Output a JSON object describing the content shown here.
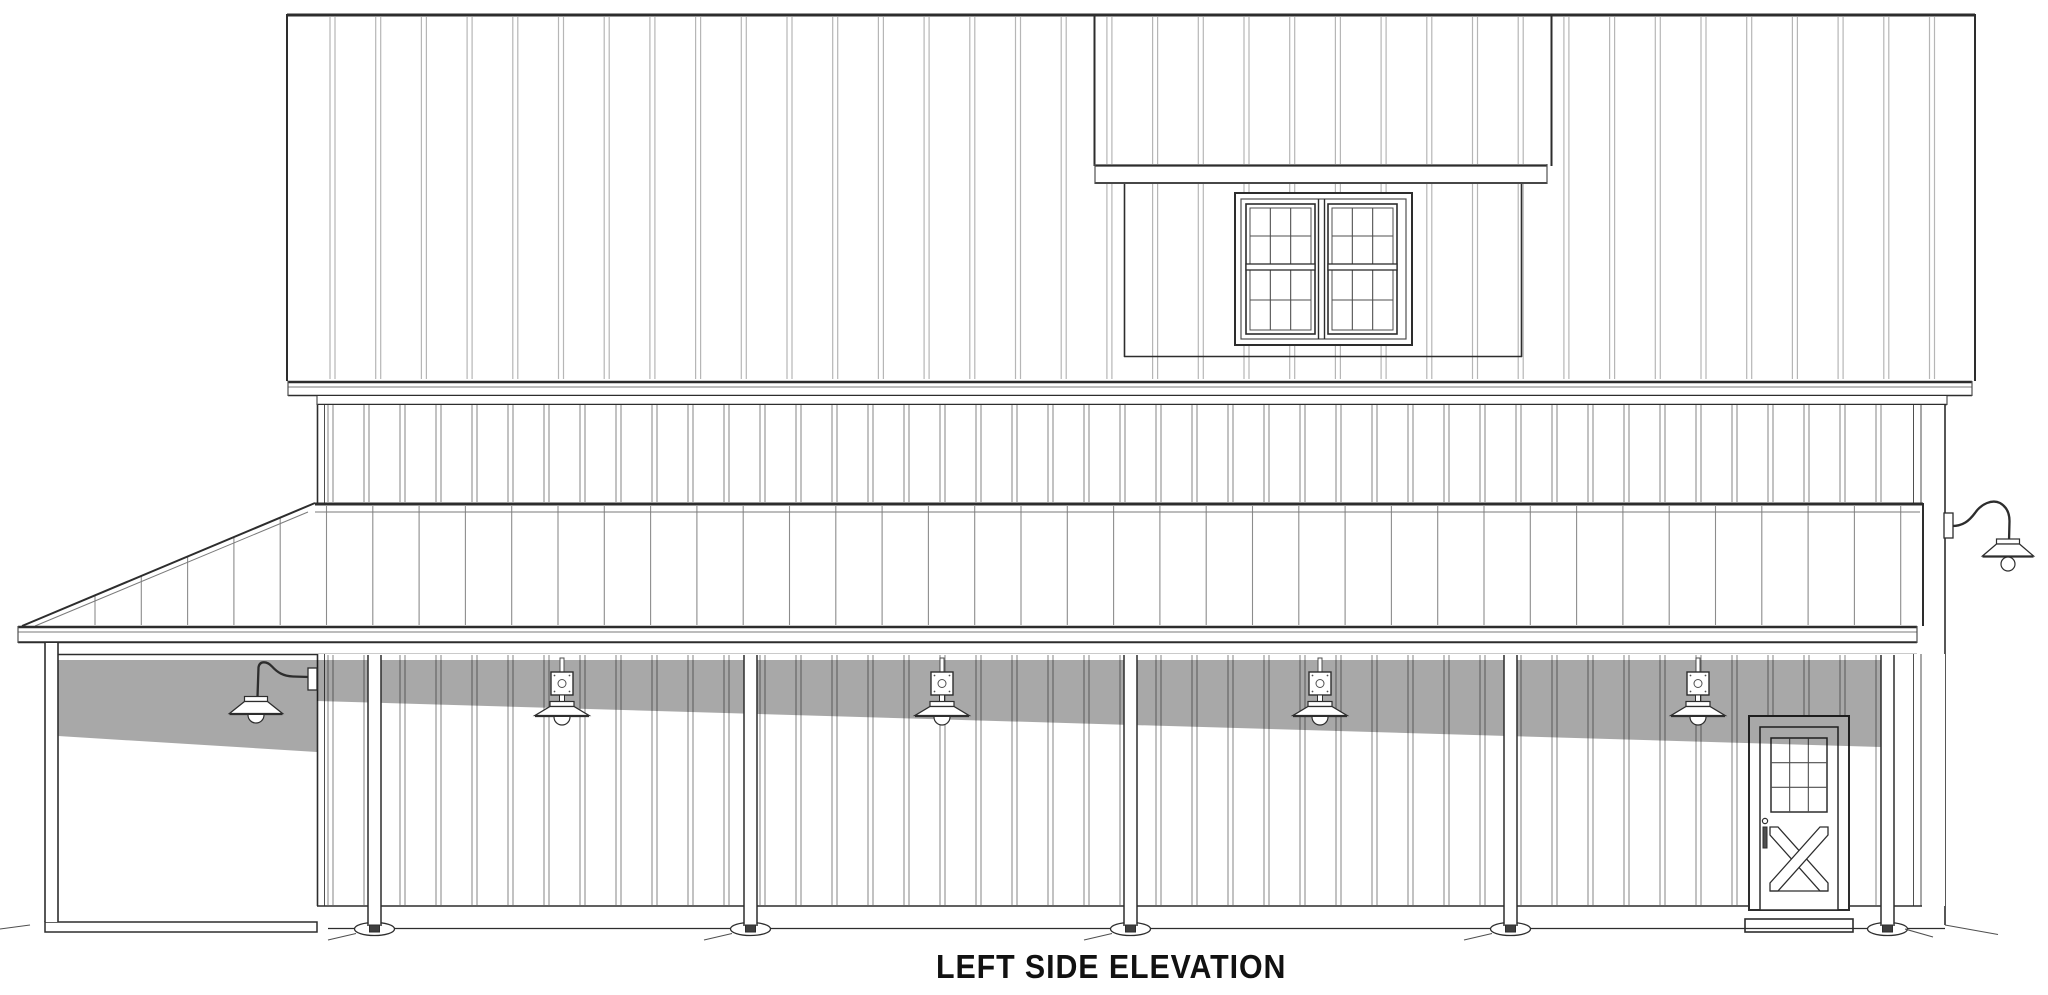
{
  "title": {
    "text": "LEFT SIDE ELEVATION"
  },
  "drawing": {
    "canvas": {
      "width": 2048,
      "height": 995,
      "bg": "#ffffff"
    },
    "palette": {
      "dark": "#2d2d2d",
      "med": "#4f4f4f",
      "soft": "#7a7a7a",
      "batten_light": "#b6b6b6",
      "batten_mid": "#8f8f8f",
      "seam": "#8c8c8c",
      "white": "#ffffff",
      "shadow_color": "#000000",
      "shadow_alpha": 0.34,
      "foot": "#3f3f3f"
    },
    "upper_wall": {
      "x1": 287,
      "y1": 14,
      "x2": 1975,
      "y2": 381,
      "batten_start": 330,
      "batten_step": 45.7,
      "batten_gap": 5
    },
    "dormer": {
      "x1": 1094,
      "x2": 1552,
      "side_y1": 15,
      "side_y2": 166,
      "fascia": {
        "x1": 1095,
        "y1": 164,
        "x2": 1547,
        "y2": 184
      },
      "inner": {
        "x1": 1124,
        "x2": 1522,
        "y1": 184,
        "y2": 357
      }
    },
    "window": {
      "outer": {
        "x": 1235,
        "y": 193,
        "w": 177,
        "h": 152
      },
      "frame_inset": 6,
      "mullion_x1": 1318.5,
      "mullion_x2": 1324.5,
      "sashes": [
        {
          "x": 1246,
          "y": 204,
          "w": 69,
          "h": 130
        },
        {
          "x": 1328,
          "y": 204,
          "w": 69,
          "h": 130
        }
      ],
      "glass_inset": 4,
      "muntin_rows_y": [
        236,
        300
      ],
      "meeting_rail": {
        "y": 264,
        "h": 6
      }
    },
    "bands": {
      "band1": {
        "x1": 288,
        "y1": 381,
        "x2": 1972,
        "y2": 396,
        "thin_y": 387
      },
      "band2": {
        "x1": 317,
        "y1": 396,
        "x2": 1947,
        "y2": 405
      }
    },
    "mid_wall": {
      "x1": 317,
      "y1": 405,
      "x2": 1945,
      "y2": 503,
      "batten_start": 328,
      "batten_step": 36,
      "batten_gap": 5,
      "trim_left": [
        317.5,
        324.5
      ],
      "trim_right": [
        1913.5,
        1921
      ],
      "right_edge_x": 1945
    },
    "roof": {
      "top_y": 503,
      "eave_y": 626,
      "x_right": 1923,
      "slope_tip_x": 22,
      "slope_top_x": 315,
      "inner_top_y": 512,
      "seam_start": 95,
      "seam_step": 46.3,
      "slope_rate": 0.42,
      "fascia": {
        "x1": 18,
        "x2": 1917,
        "y1": 626,
        "mid_y": 632,
        "y2": 643
      }
    },
    "header": {
      "x1": 50,
      "x2": 1917,
      "y": 654.5
    },
    "porch_wall": {
      "x1": 317,
      "y1": 654,
      "x2": 1945,
      "y2": 906,
      "batten_start": 328,
      "batten_step": 36,
      "batten_gap": 5,
      "trim_left": [
        317.5,
        324.5
      ],
      "trim_right": [
        1913.5,
        1921
      ],
      "siding_bottom_y": 906,
      "siding_bottom_x2": 1922
    },
    "shadow": {
      "bay_poly": [
        [
          58,
          660
        ],
        [
          317,
          660
        ],
        [
          317,
          752
        ],
        [
          58,
          736
        ]
      ],
      "wall_poly": [
        [
          317,
          660
        ],
        [
          1881,
          660
        ],
        [
          1881,
          747
        ],
        [
          317,
          701
        ]
      ]
    },
    "door": {
      "trim": {
        "x": 1749,
        "y": 716,
        "w": 100,
        "h": 194
      },
      "slab": {
        "x": 1760,
        "y": 727,
        "w": 78,
        "h": 183
      },
      "glass": {
        "x": 1771,
        "y": 738,
        "w": 56,
        "h": 74,
        "cols": 3,
        "rows": 3
      },
      "handle": {
        "cx": 1765,
        "cy": 821,
        "r": 2.6,
        "bar": {
          "x": 1763,
          "y": 827,
          "w": 4,
          "h": 21
        }
      },
      "crossbuck": {
        "x1": 1770,
        "y1": 827,
        "x2": 1828,
        "y2": 891,
        "brace_w": 8
      },
      "bottom_rail_y": 891,
      "step": {
        "x": 1745,
        "y": 919,
        "w": 108,
        "h": 13
      }
    },
    "posts": {
      "xs": [
        368,
        744,
        1124,
        1504,
        1881
      ],
      "w": 13,
      "top": 655,
      "bottom": 926,
      "base": {
        "ry": 6.5,
        "rx": 20,
        "cy": 929
      },
      "hatch_left_ids": [
        0,
        1,
        2,
        3
      ],
      "hatch_right_ids": [
        4
      ]
    },
    "corner_post": {
      "x": 45,
      "w": 13,
      "top": 643,
      "bottom": 922
    },
    "slab": {
      "x": 45,
      "y": 922,
      "w": 272,
      "h": 10
    },
    "ground": {
      "y": 928.5,
      "x1": 328,
      "x2": 1945,
      "left_tick": [
        [
          0,
          929
        ],
        [
          30,
          925
        ]
      ],
      "right_diag": [
        [
          1945,
          925
        ],
        [
          1998,
          934.5
        ]
      ]
    },
    "lights": {
      "wall_xs": [
        562,
        942,
        1320,
        1698
      ],
      "wall_geom": {
        "conduit": {
          "w": 4,
          "y1": 658,
          "y2": 672
        },
        "plate": {
          "w": 22,
          "y1": 672,
          "y2": 695
        },
        "stem": {
          "w": 5,
          "y1": 695,
          "y2": 702
        },
        "cap": {
          "w": 24,
          "y1": 701.5,
          "y2": 706.5
        },
        "shade": {
          "top_w": 24,
          "bot_w": 54,
          "y1": 706.5,
          "y2": 715.5
        },
        "bulb_r": 8
      },
      "gooseneck_left": {
        "plate": {
          "x": 308,
          "y": 668,
          "w": 9,
          "h": 22
        },
        "arm": "M 309 677 L 293 676.5 C 283 676 277.5 672.5 272 666.5 C 267 661 259.5 660.5 258.5 667.5 L 257.5 697",
        "cx": 256,
        "cap": {
          "w": 23,
          "y1": 696.5,
          "y2": 701.5
        },
        "shade": {
          "top_w": 23,
          "bot_w": 53,
          "y1": 701.5,
          "y2": 713.5
        },
        "bulb_r": 8
      },
      "gooseneck_right": {
        "plate": {
          "x": 1944,
          "y": 513,
          "w": 9,
          "h": 25
        },
        "arm": "M 1952 526 C 1963 526 1969 521 1975 513 C 1981 504 1992 499 2000 503 C 2007 507 2009.5 514 2009.5 521 L 2009 541",
        "cx": 2008,
        "cap": {
          "w": 23,
          "y1": 539,
          "y2": 544
        },
        "shade": {
          "top_w": 23,
          "bot_w": 51,
          "y1": 544,
          "y2": 556
        },
        "bulb_r": 7
      }
    }
  }
}
